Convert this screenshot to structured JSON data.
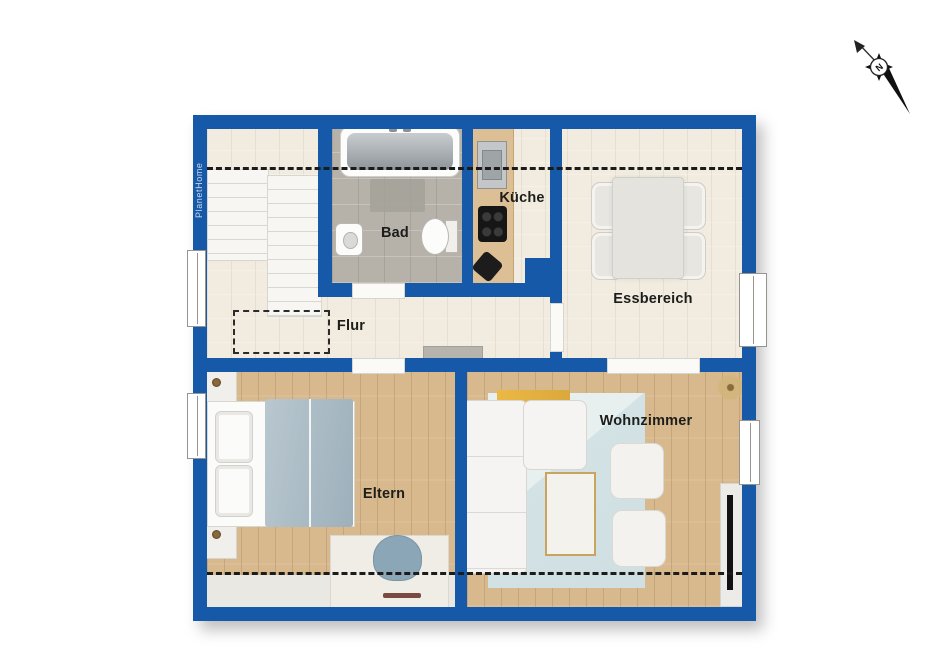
{
  "meta": {
    "watermark": "PlanetHome",
    "compass_label": "N"
  },
  "colors": {
    "wall": "#1659a9",
    "floor": "#f1ecdf",
    "tile": "#b6b2aa",
    "wood": "#d8b98d",
    "rug": "#cfdfe2",
    "accent": "#ecb845"
  },
  "rooms": [
    {
      "id": "bad",
      "label": "Bad"
    },
    {
      "id": "kueche",
      "label": "Küche"
    },
    {
      "id": "essbereich",
      "label": "Essbereich"
    },
    {
      "id": "flur",
      "label": "Flur"
    },
    {
      "id": "eltern",
      "label": "Eltern"
    },
    {
      "id": "wohnzimmer",
      "label": "Wohnzimmer"
    }
  ]
}
